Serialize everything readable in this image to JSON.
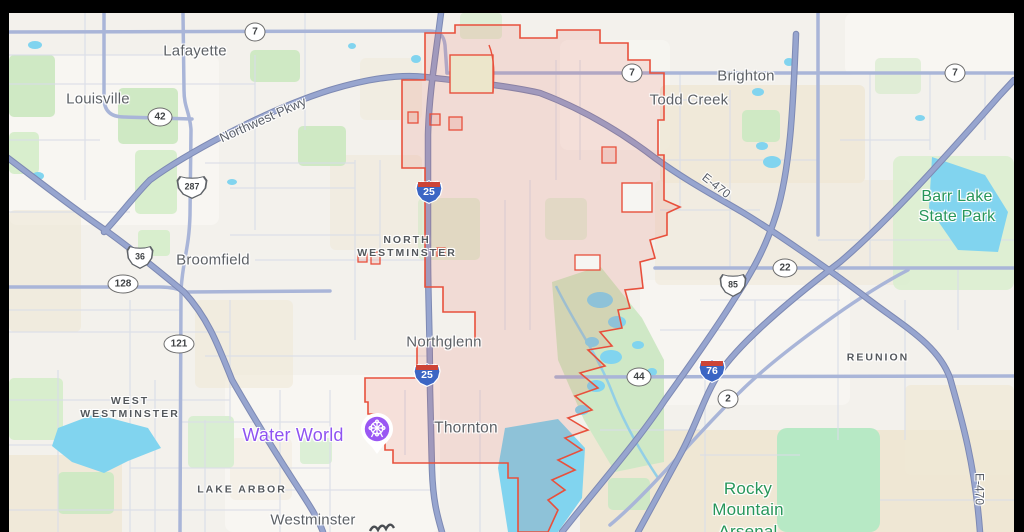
{
  "app": {
    "kind": "web-map-screenshot",
    "style": "light-road-map"
  },
  "map": {
    "frame": {
      "letterbox_color": "#000000",
      "top_bar_px": 13,
      "left_bar_px": 9,
      "right_bar_px": 10
    },
    "boundary": {
      "name": "Thornton city limits (red outlined region)",
      "stroke": "#e8503c",
      "fill": "rgba(232,80,60,0.13)"
    },
    "colors": {
      "land": "#f3f1ec",
      "urban": "#fbfaf7",
      "terrain_beige": "#efe8d6",
      "park_green": "#cfe9c4",
      "preserve_green": "#b7e9c5",
      "water": "#81d4ef",
      "highway": "#97a5cf",
      "highway_casing": "#7d89b3",
      "secondary_road": "#a9b5d8",
      "minor_road": "#d9dde8",
      "city_text": "#5d6166",
      "park_text": "#27965a",
      "poi_text": "#8f53f1",
      "boundary_red": "#e8503c"
    },
    "labels": {
      "cities": [
        {
          "text": "Lafayette"
        },
        {
          "text": "Louisville"
        },
        {
          "text": "Brighton"
        },
        {
          "text": "Todd Creek"
        },
        {
          "text": "Broomfield"
        },
        {
          "text": "Northglenn"
        },
        {
          "text": "Thornton"
        },
        {
          "text": "Westminster"
        }
      ],
      "districts": [
        {
          "line1": "NORTH",
          "line2": "WESTMINSTER"
        },
        {
          "line1": "WEST",
          "line2": "WESTMINSTER"
        },
        {
          "line1": "LAKE ARBOR",
          "line2": ""
        },
        {
          "line1": "REUNION",
          "line2": ""
        }
      ],
      "parks": [
        {
          "line1": "Barr Lake",
          "line2": "State Park",
          "line3": ""
        },
        {
          "line1": "Rocky",
          "line2": "Mountain",
          "line3": "Arsenal"
        }
      ],
      "poi": {
        "text": "Water World",
        "marker": "purple-ferris-wheel-pin"
      }
    },
    "road_names": [
      {
        "text": "Northwest Pkwy",
        "angle_deg": -24
      },
      {
        "text": "E-470",
        "angle_deg": 38
      },
      {
        "text": "E-470",
        "angle_deg": 90
      }
    ],
    "shields": [
      {
        "type": "state-oval",
        "label": "7"
      },
      {
        "type": "state-oval",
        "label": "7"
      },
      {
        "type": "state-oval",
        "label": "7"
      },
      {
        "type": "state-oval",
        "label": "42"
      },
      {
        "type": "state-oval",
        "label": "128"
      },
      {
        "type": "state-oval",
        "label": "121"
      },
      {
        "type": "state-oval",
        "label": "22"
      },
      {
        "type": "state-oval",
        "label": "44"
      },
      {
        "type": "state-oval",
        "label": "2"
      },
      {
        "type": "us-route",
        "label": "287"
      },
      {
        "type": "us-route",
        "label": "36"
      },
      {
        "type": "us-route",
        "label": "85"
      },
      {
        "type": "interstate",
        "label": "25"
      },
      {
        "type": "interstate",
        "label": "25"
      },
      {
        "type": "interstate",
        "label": "76"
      }
    ]
  }
}
